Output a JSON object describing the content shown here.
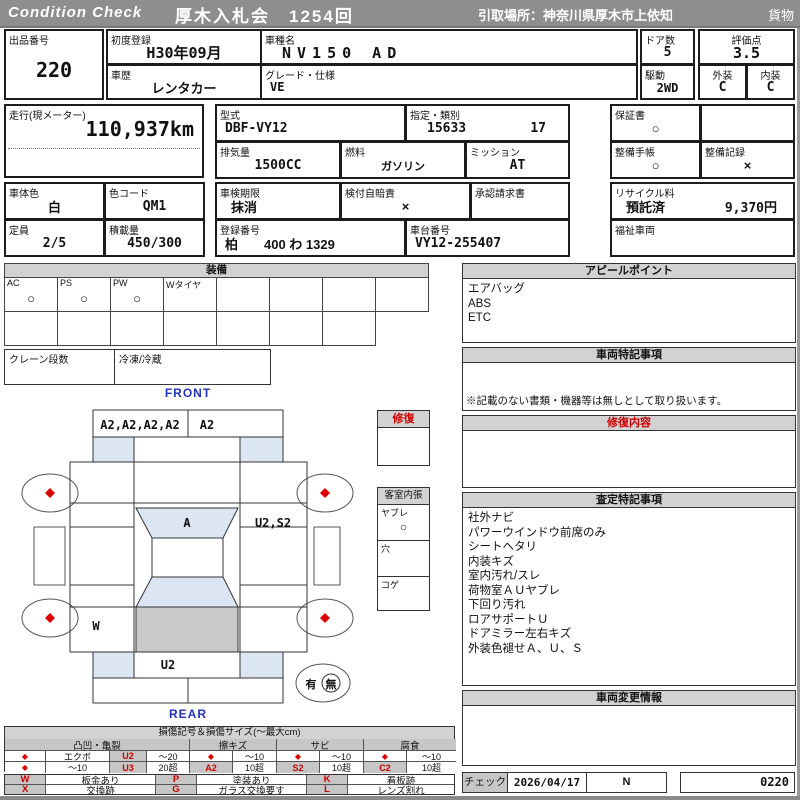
{
  "colors": {
    "red": "#cc0000",
    "blue": "#2233bb",
    "header_gray": "#8e8e8e",
    "panel_gray": "#d2d2d2",
    "cell_gray": "#c6c6c6",
    "light_blue": "#dbe6f2",
    "cargo_gray": "#c9c9c9"
  },
  "header": {
    "logo": "Condition Check",
    "auction": "厚木入札会　1254回",
    "pickup": "引取場所：神奈川県厚木市上依知",
    "category": "貨物"
  },
  "info": {
    "lot_label": "出品番号",
    "lot": "220",
    "first_reg_label": "初度登録",
    "first_reg": "H30年09月",
    "history_label": "車歴",
    "history": "レンタカー",
    "model_name_label": "車種名",
    "model_name": "NV150 AD",
    "grade_label": "グレード・仕様",
    "grade": "VE",
    "doors_label": "ドア数",
    "doors": "5",
    "drive_label": "駆動",
    "drive": "2WD",
    "score_label": "評価点",
    "score": "3.5",
    "exterior_label": "外装",
    "exterior": "C",
    "interior_label": "内装",
    "interior": "C",
    "mileage_label": "走行(現メーター)",
    "mileage": "110,937km",
    "model_code_label": "型式",
    "model_code": "DBF-VY12",
    "class_label": "指定・類別",
    "class_no": "15633",
    "class_no2": "17",
    "displacement_label": "排気量",
    "displacement": "1500CC",
    "fuel_label": "燃料",
    "fuel": "ガソリン",
    "mission_label": "ミッション",
    "mission": "AT",
    "warranty_label": "保証書",
    "warranty": "○",
    "maintenance_book_label": "整備手帳",
    "maintenance_book": "○",
    "maintenance_record_label": "整備記録",
    "maintenance_record": "×",
    "body_color_label": "車体色",
    "body_color": "白",
    "color_code_label": "色コード",
    "color_code": "QM1",
    "capacity_label": "定員",
    "capacity": "2/5",
    "load_label": "積載量",
    "load": "450/300",
    "inspection_label": "車検期限",
    "inspection": "抹消",
    "insurance_label": "検付自賠責",
    "insurance": "×",
    "approval_label": "承認請求書",
    "approval": "",
    "reg_no_label": "登録番号",
    "reg_no": "柏　　400 わ 1329",
    "chassis_label": "車台番号",
    "chassis": "VY12-255407",
    "recycle_label": "リサイクル料",
    "recycle_status": "預託済",
    "recycle_fee": "9,370円",
    "welfare_label": "福祉車両",
    "welfare": ""
  },
  "equipment": {
    "title": "装備",
    "items": [
      {
        "label": "AC",
        "value": "○"
      },
      {
        "label": "PS",
        "value": "○"
      },
      {
        "label": "PW",
        "value": "○"
      },
      {
        "label": "Wタイヤ",
        "value": ""
      },
      {
        "label": "",
        "value": ""
      },
      {
        "label": "",
        "value": ""
      },
      {
        "label": "",
        "value": ""
      },
      {
        "label": "",
        "value": ""
      }
    ],
    "crane_label": "クレーン段数",
    "crane": "",
    "fridge_label": "冷凍/冷蔵",
    "fridge": ""
  },
  "repair": {
    "title": "修復",
    "content": ""
  },
  "cabin": {
    "title": "客室内張",
    "rows": [
      {
        "label": "ヤブレ",
        "value": "○"
      },
      {
        "label": "穴",
        "value": ""
      },
      {
        "label": "コゲ",
        "value": ""
      }
    ]
  },
  "diagram": {
    "front": "FRONT",
    "rear": "REAR",
    "front_bumper_left": "A2,A2,A2,A2",
    "front_bumper_right": "A2",
    "windshield": "A",
    "right_side": "U2,S2",
    "left_rear": "W",
    "rear_panel": "U2",
    "spare_yes": "有",
    "spare_no": "無"
  },
  "panels": {
    "appeal": {
      "title": "アピールポイント",
      "lines": [
        "エアバッグ",
        "ABS",
        "ETC"
      ]
    },
    "special": {
      "title": "車両特記事項",
      "note": "※記載のない書類・機器等は無しとして取り扱います。"
    },
    "repair_detail": {
      "title": "修復内容",
      "content": ""
    },
    "assessment": {
      "title": "査定特記事項",
      "lines": [
        "社外ナビ",
        "パワーウインドウ前席のみ",
        "シートヘタリ",
        "内装キズ",
        "室内汚れ/スレ",
        "荷物室ＡＵヤブレ",
        "下回り汚れ",
        "ロアサポートＵ",
        "ドアミラー左右キズ",
        "外装色褪せＡ、Ｕ、Ｓ"
      ]
    },
    "change_info": {
      "title": "車両変更情報",
      "content": ""
    }
  },
  "check": {
    "label": "チェック",
    "date": "2026/04/17",
    "value": "N",
    "number": "0220"
  },
  "legend": {
    "title": "損傷記号＆損傷サイズ(～最大cm)",
    "groups": [
      {
        "name": "凸凹・亀裂"
      },
      {
        "name": "擦キズ"
      },
      {
        "name": "サビ"
      },
      {
        "name": "腐食"
      }
    ],
    "row1": [
      "◆",
      "エクボ",
      "U2",
      "～20",
      "◆",
      "～10",
      "◆",
      "～10",
      "◆",
      "～10"
    ],
    "row2": [
      "◆",
      "～10",
      "U3",
      "20超",
      "A2",
      "10超",
      "S2",
      "10超",
      "C2",
      "10超"
    ],
    "marks": [
      [
        "W",
        "板金あり"
      ],
      [
        "X",
        "交換跡"
      ],
      [
        "P",
        "塗装あり"
      ],
      [
        "G",
        "ガラス交換要す"
      ],
      [
        "K",
        "看板跡"
      ],
      [
        "L",
        "レンズ割れ"
      ]
    ]
  }
}
